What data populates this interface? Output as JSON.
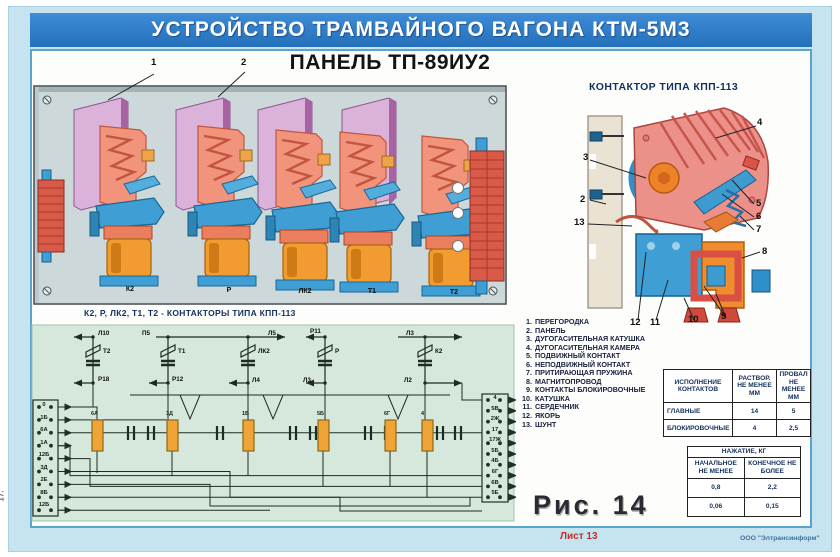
{
  "poster": {
    "banner": "УСТРОЙСТВО ТРАМВАЙНОГО ВАГОНА КТМ-5М3",
    "subtitle": "ПАНЕЛЬ ТП-89ИУ2",
    "figure": "Рис. 14",
    "sheet": "Лист 13",
    "publisher": "ООО \"Элтрансинформ\"",
    "page_side": "17."
  },
  "panel": {
    "caption": "К2, Р, ЛК2, Т1, Т2 - КОНТАКТОРЫ ТИПА КПП-113",
    "contactors": [
      "К2",
      "Р",
      "ЛК2",
      "Т1",
      "Т2"
    ],
    "callout_1": "1",
    "callout_2": "2"
  },
  "detail": {
    "title": "КОНТАКТОР ТИПА КПП-113",
    "callouts": {
      "c2": "2",
      "c3": "3",
      "c4": "4",
      "c5": "5",
      "c6": "6",
      "c7": "7",
      "c8": "8",
      "c9": "9",
      "c10": "10",
      "c11": "11",
      "c12": "12",
      "c13": "13"
    }
  },
  "parts": {
    "items": [
      {
        "n": "1.",
        "t": "ПЕРЕГОРОДКА"
      },
      {
        "n": "2.",
        "t": "ПАНЕЛЬ"
      },
      {
        "n": "3.",
        "t": "ДУГОГАСИТЕЛЬНАЯ КАТУШКА"
      },
      {
        "n": "4.",
        "t": "ДУГОГАСИТЕЛЬНАЯ КАМЕРА"
      },
      {
        "n": "5.",
        "t": "ПОДВИЖНЫЙ КОНТАКТ"
      },
      {
        "n": "6.",
        "t": "НЕПОДВИЖНЫЙ КОНТАКТ"
      },
      {
        "n": "7.",
        "t": "ПРИТИРАЮЩАЯ ПРУЖИНА"
      },
      {
        "n": "8.",
        "t": "МАГНИТОПРОВОД"
      },
      {
        "n": "9.",
        "t": "КОНТАКТЫ БЛОКИРОВОЧНЫЕ"
      },
      {
        "n": "10.",
        "t": "КАТУШКА"
      },
      {
        "n": "11.",
        "t": "СЕРДЕЧНИК"
      },
      {
        "n": "12.",
        "t": "ЯКОРЬ"
      },
      {
        "n": "13.",
        "t": "ШУНТ"
      }
    ]
  },
  "contacts_table": {
    "col1": "ИСПОЛНЕНИЕ КОНТАКТОВ",
    "col2": "РАСТВОР. НЕ МЕНЕЕ ММ",
    "col3": "ПРОВАЛ НЕ МЕНЕЕ ММ",
    "rows": [
      {
        "name": "ГЛАВНЫЕ",
        "a": "14",
        "b": "5"
      },
      {
        "name": "БЛОКИРОВОЧНЫЕ",
        "a": "4",
        "b": "2,5"
      }
    ]
  },
  "pressure_table": {
    "title": "НАЖАТИЕ, КГ",
    "col1": "НАЧАЛЬНОЕ НЕ МЕНЕЕ",
    "col2": "КОНЕЧНОЕ НЕ БОЛЕЕ",
    "rows": [
      {
        "a": "0,8",
        "b": "2,2"
      },
      {
        "a": "0,06",
        "b": "0,15"
      }
    ]
  },
  "schematic": {
    "relays": [
      {
        "top": "Л10",
        "coil": "Т2",
        "bottom": "Р18"
      },
      {
        "top": "П5",
        "coil": "Т1",
        "bottom": "Р12"
      },
      {
        "top": "Л5",
        "coil": "ЛК2",
        "bottom": "Л4"
      },
      {
        "top": "Р11",
        "coil": "Р",
        "bottom": "Л3"
      },
      {
        "top": "Л3",
        "coil": "К2",
        "bottom": "Л2"
      }
    ],
    "left_terminals": [
      "0",
      "1Б",
      "6А",
      "1А",
      "12Б",
      "3Д",
      "2Е",
      "8Б",
      "12Б"
    ],
    "right_terminals": [
      "4",
      "5В",
      "2Ж",
      "17",
      "17Ж",
      "5Б",
      "4Б",
      "6Г",
      "6В",
      "5Е"
    ],
    "resistor_labels": [
      "6А",
      "3Д",
      "1Б",
      "5Б",
      "6Г",
      "4"
    ]
  }
}
